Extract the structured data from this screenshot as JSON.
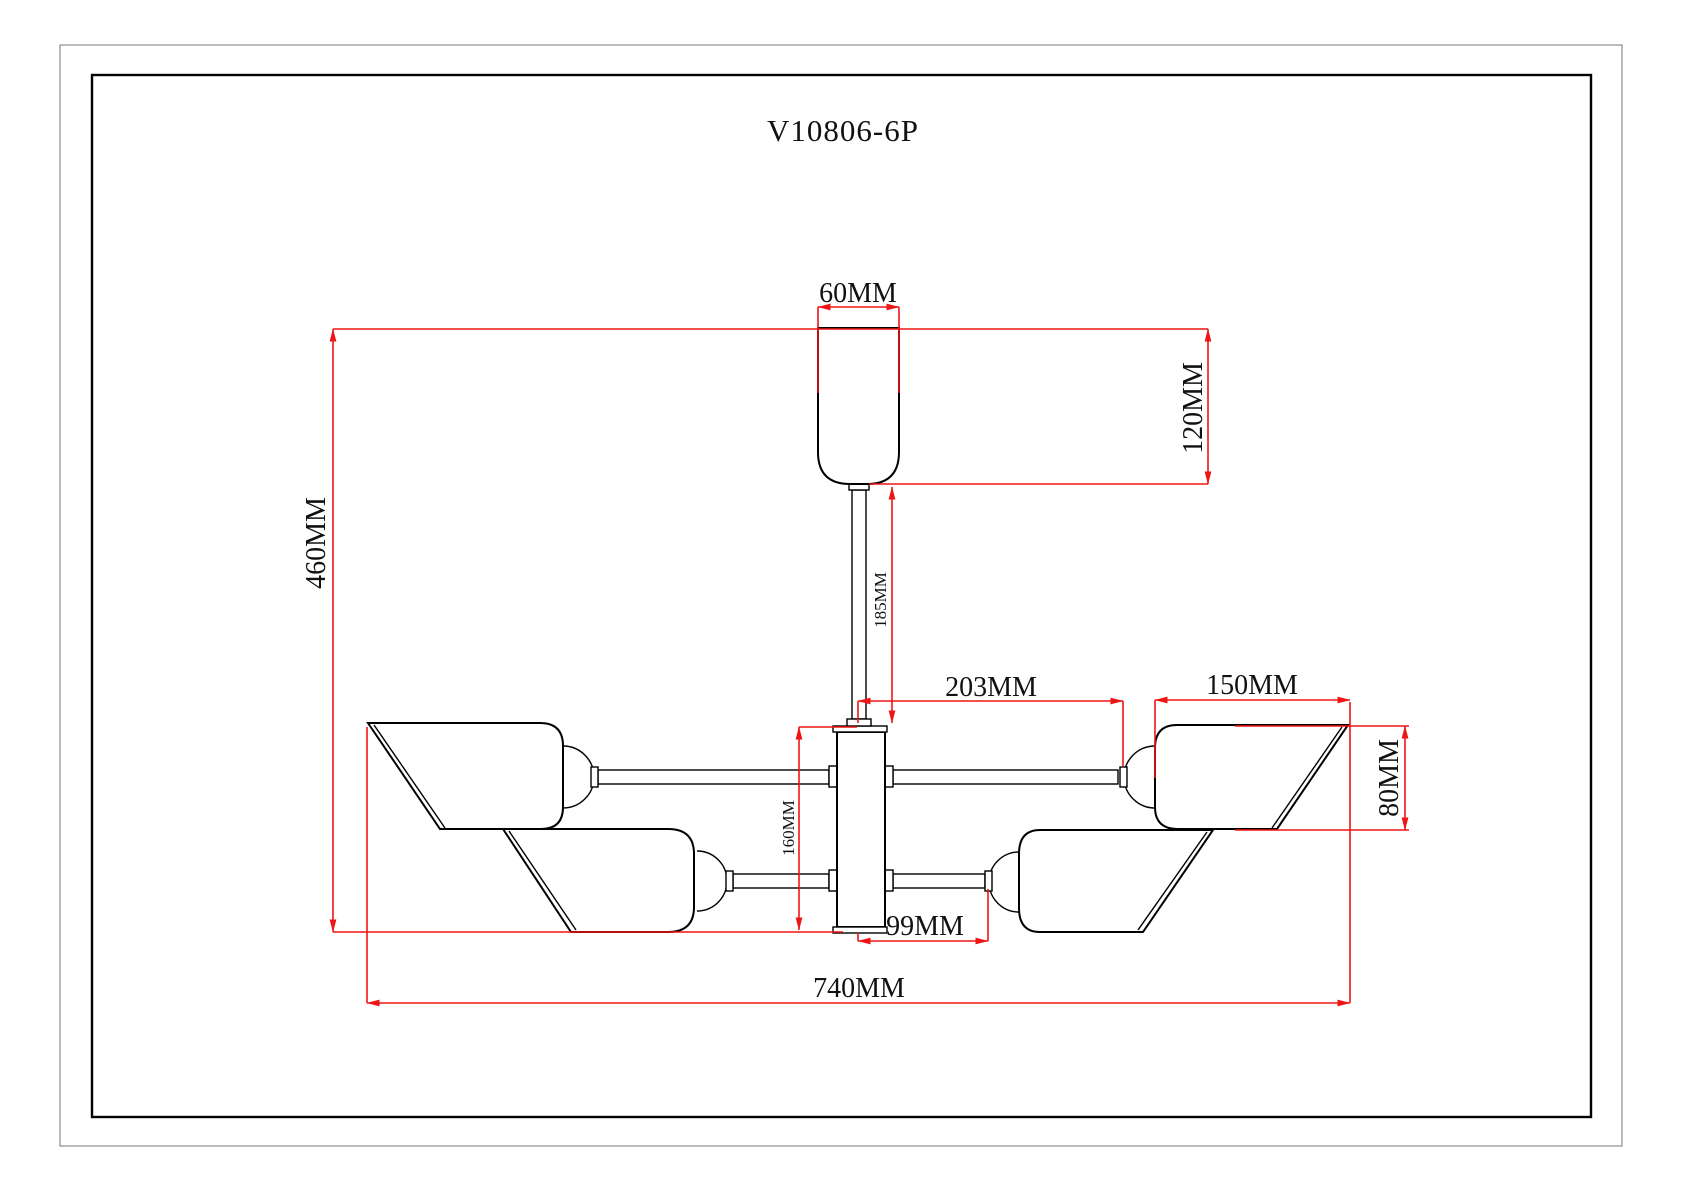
{
  "drawing": {
    "model_number": "V10806-6P",
    "units": "MM",
    "type": "ceiling-lamp-dimension-drawing",
    "lamp_count": 6
  },
  "colors": {
    "dimension_lines": "#ee1515",
    "outline": "#000000",
    "background": "#ffffff"
  },
  "dimensions": {
    "canopy_width": {
      "label": "60MM",
      "value": 60,
      "unit": "MM",
      "orientation": "horizontal",
      "measures": "ceiling canopy width"
    },
    "canopy_height": {
      "label": "120MM",
      "value": 120,
      "unit": "MM",
      "orientation": "vertical",
      "measures": "canopy height"
    },
    "total_height": {
      "label": "460MM",
      "value": 460,
      "unit": "MM",
      "orientation": "vertical",
      "measures": "overall fixture height"
    },
    "stem_length": {
      "label": "185MM",
      "value": 185,
      "unit": "MM",
      "orientation": "vertical",
      "measures": "down-rod length"
    },
    "upper_arm_reach": {
      "label": "203MM",
      "value": 203,
      "unit": "MM",
      "orientation": "horizontal",
      "measures": "upper arm reach from center"
    },
    "shade_width": {
      "label": "150MM",
      "value": 150,
      "unit": "MM",
      "orientation": "horizontal",
      "measures": "shade width"
    },
    "shade_height": {
      "label": "80MM",
      "value": 80,
      "unit": "MM",
      "orientation": "vertical",
      "measures": "shade height"
    },
    "hub_height": {
      "label": "160MM",
      "value": 160,
      "unit": "MM",
      "orientation": "vertical",
      "measures": "central hub height"
    },
    "lower_arm_reach": {
      "label": "99MM",
      "value": 99,
      "unit": "MM",
      "orientation": "horizontal",
      "measures": "lower arm reach from center"
    },
    "total_width": {
      "label": "740MM",
      "value": 740,
      "unit": "MM",
      "orientation": "horizontal",
      "measures": "overall fixture width"
    }
  }
}
